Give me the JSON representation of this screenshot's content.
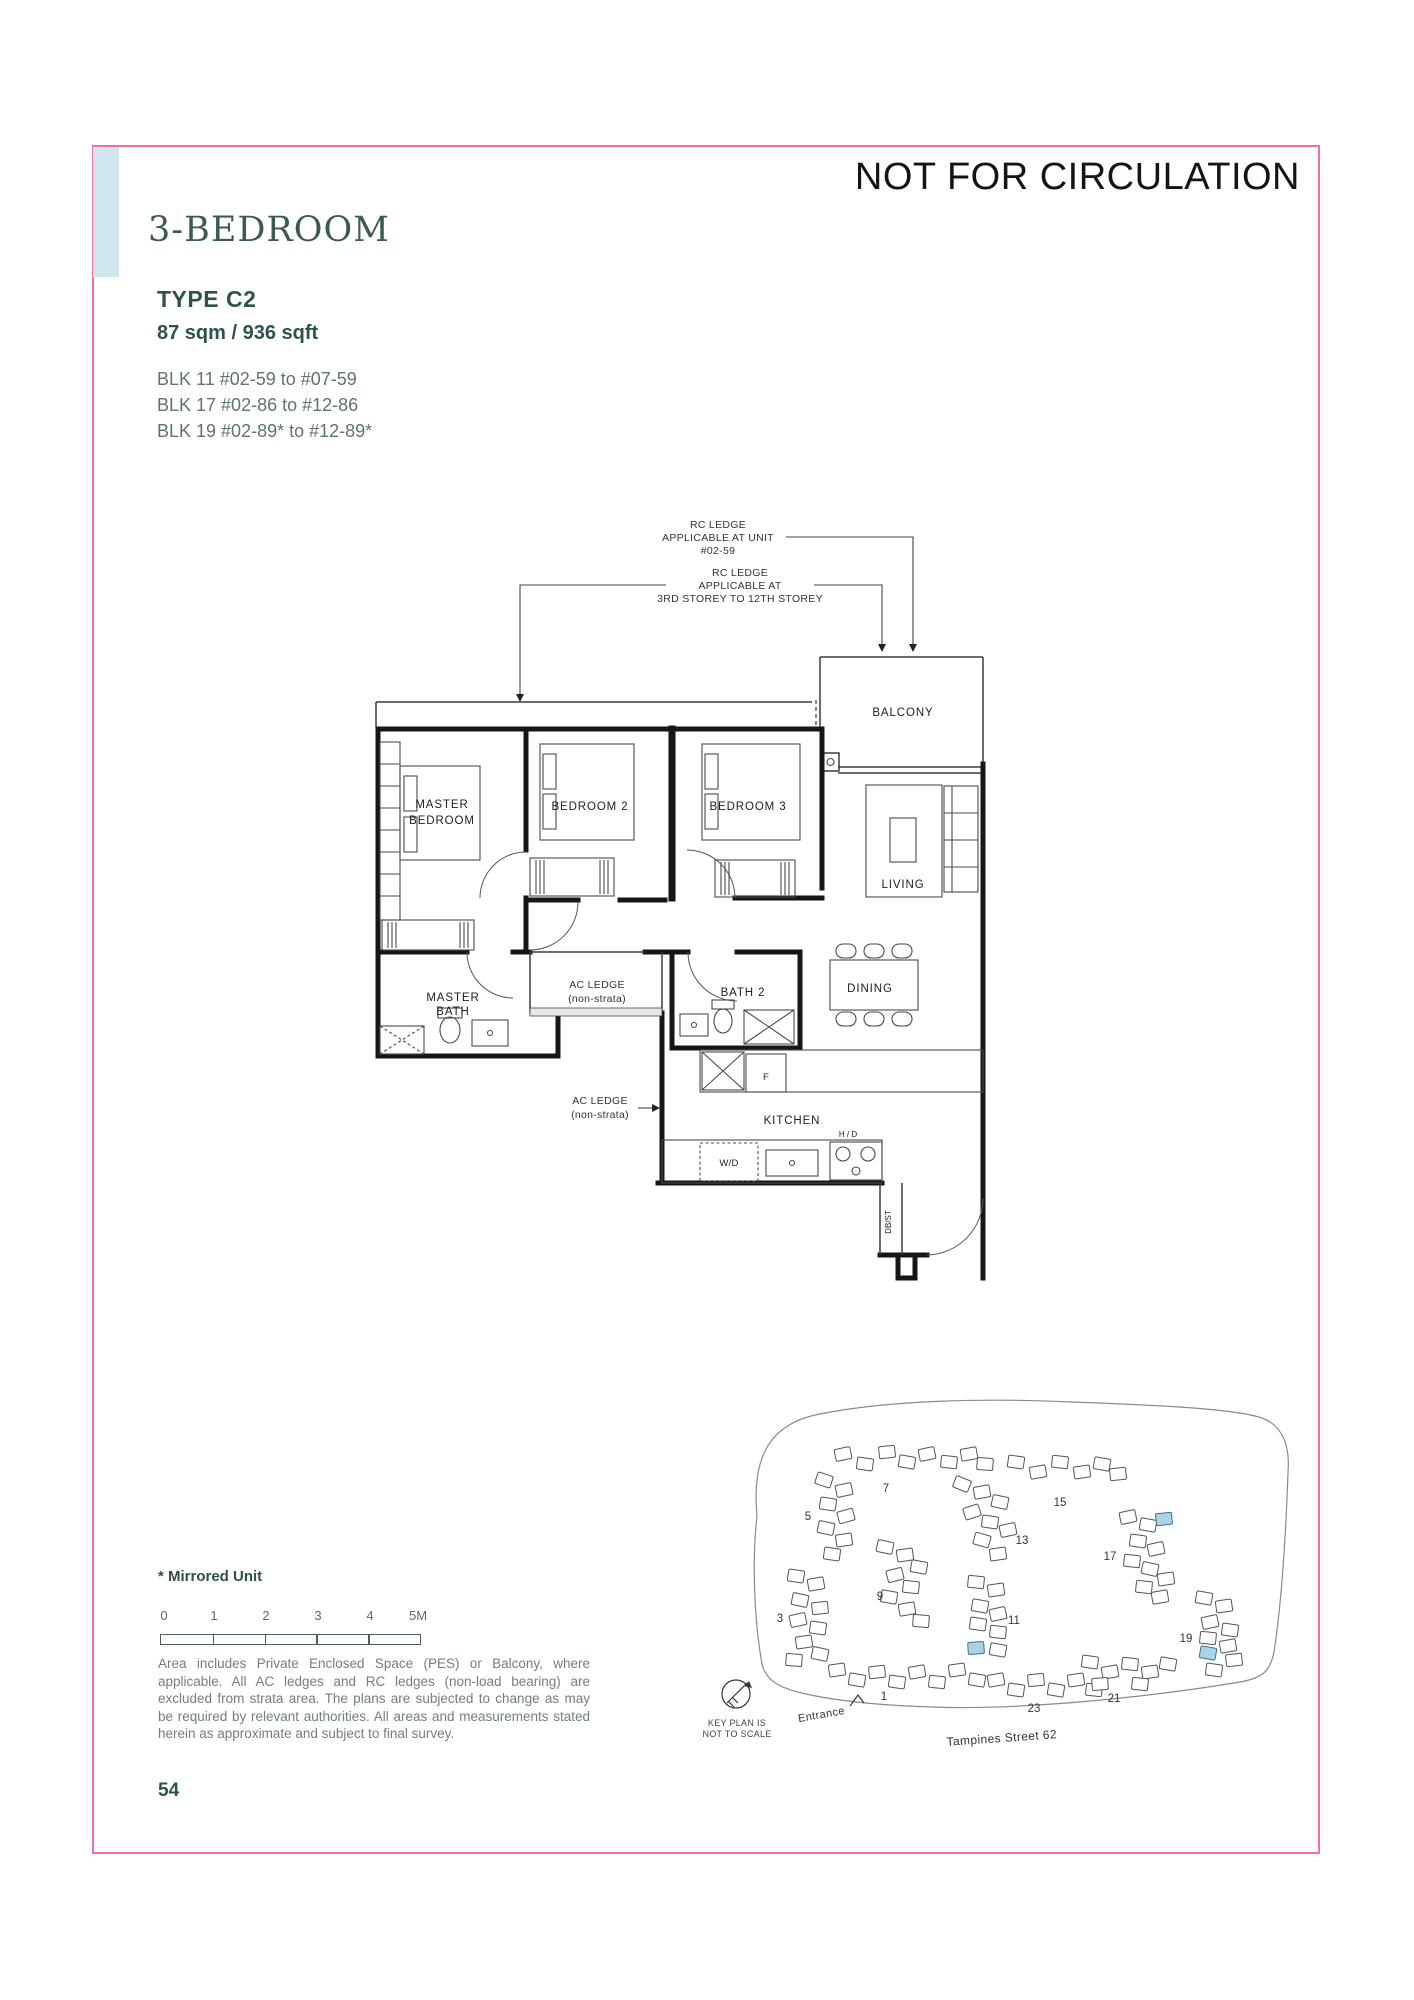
{
  "page": {
    "watermark": "NOT FOR CIRCULATION",
    "page_number": "54"
  },
  "header": {
    "title": "3-BEDROOM",
    "unit_type": "TYPE C2",
    "area": "87 sqm / 936 sqft",
    "blocks": [
      "BLK 11 #02-59 to #07-59",
      "BLK 17 #02-86 to #12-86",
      "BLK 19 #02-89* to #12-89*"
    ]
  },
  "floor_plan": {
    "labels": {
      "master_l1": "MASTER",
      "master_l2": "BEDROOM",
      "bedroom2": "BEDROOM 2",
      "bedroom3": "BEDROOM 3",
      "balcony": "BALCONY",
      "living": "LIVING",
      "dining": "DINING",
      "mbath_l1": "MASTER",
      "mbath_l2": "BATH",
      "bath2": "BATH 2",
      "kitchen": "KITCHEN",
      "acledge1_l1": "AC LEDGE",
      "acledge1_l2": "(non-strata)",
      "acledge2_l1": "AC LEDGE",
      "acledge2_l2": "(non-strata)",
      "wd": "W/D",
      "hd": "H / D",
      "fridge": "F",
      "dbst": "DB/ST"
    },
    "annotations": {
      "rc1_l1": "RC LEDGE",
      "rc1_l2": "APPLICABLE AT UNIT",
      "rc1_l3": "#02-59",
      "rc2_l1": "RC LEDGE",
      "rc2_l2": "APPLICABLE AT",
      "rc2_l3": "3RD STOREY TO 12TH STOREY"
    }
  },
  "key_plan": {
    "block_labels": [
      "7",
      "15",
      "5",
      "13",
      "9",
      "17",
      "3",
      "11",
      "19",
      "1",
      "23",
      "21"
    ],
    "street": "Tampines Street 62",
    "entrance": "Entrance",
    "caption_l1": "KEY PLAN IS",
    "caption_l2": "NOT TO SCALE",
    "highlight_color": "#a9d3e6"
  },
  "footer": {
    "mirrored_note": "* Mirrored Unit",
    "scale_ticks": [
      "0",
      "1",
      "2",
      "3",
      "4",
      "5M"
    ],
    "disclaimer": "Area includes Private Enclosed Space (PES) or Balcony, where applicable. All AC ledges and RC ledges (non-load bearing) are excluded from strata area. The plans are subjected to change as may be required by relevant authorities. All areas and measurements stated herein as approximate and subject to final survey."
  },
  "colors": {
    "accent_teal": "#2c544c",
    "border_pink": "#f06fa5",
    "tab_blue": "#cfe6ee",
    "highlight_blue": "#a9d3e6"
  }
}
